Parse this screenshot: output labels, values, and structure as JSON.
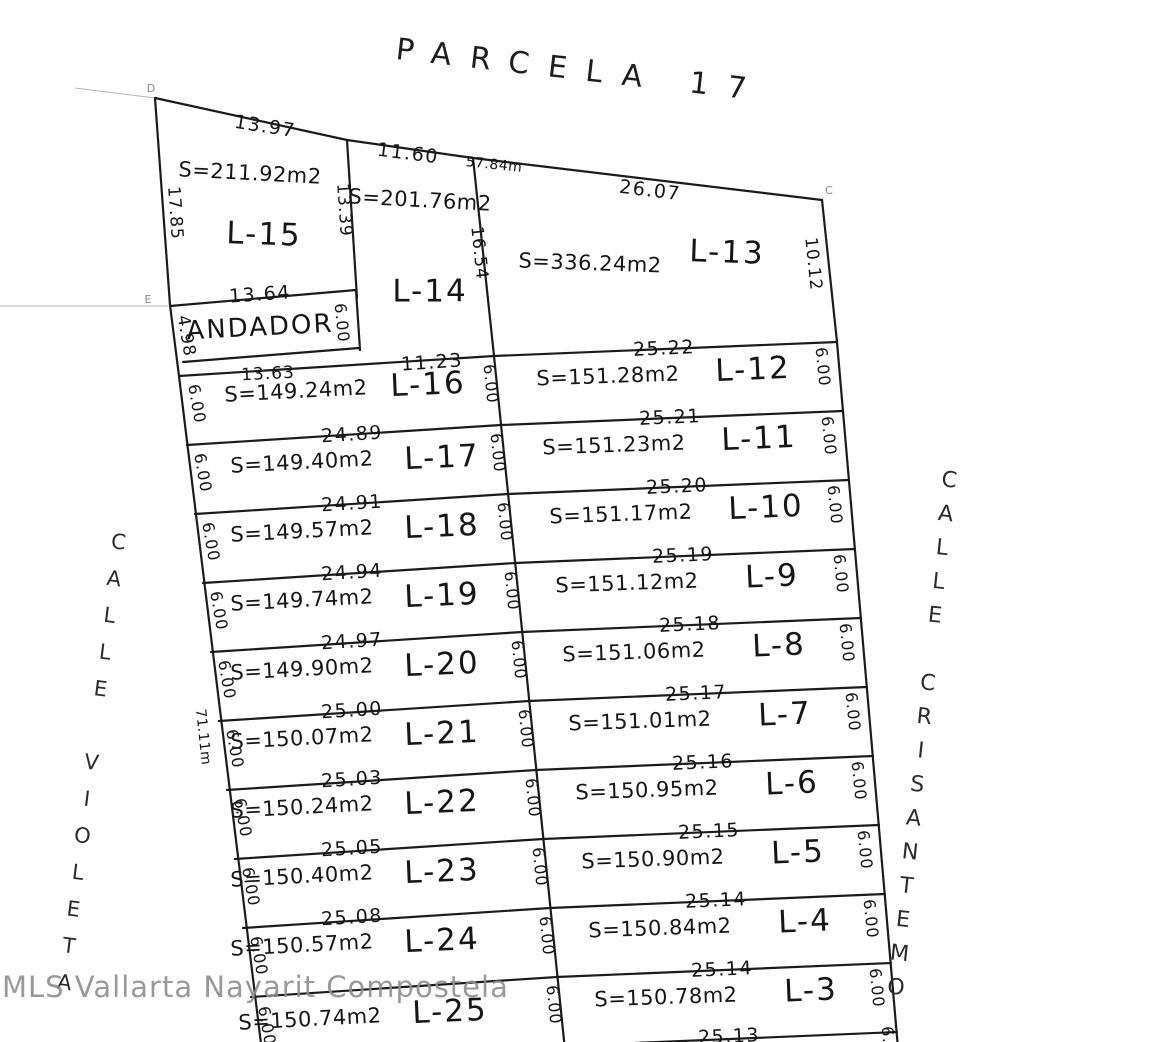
{
  "title": "PARCELA 17",
  "watermark": "MLS Vallarta Nayarit Compostela",
  "streets": {
    "left": "CALLE VIOLETA",
    "right": "CALLE CRISANTEMO"
  },
  "markers": {
    "d": "D",
    "e": "E",
    "c": "C"
  },
  "overall": {
    "top_length": "57.84m",
    "left_length": "71.11m"
  },
  "walkway": {
    "label": "ANDADOR",
    "left": "4.98",
    "right": "6.00"
  },
  "top_lots": [
    {
      "name": "L-15",
      "area": "S=211.92m2",
      "top": "13.97",
      "left": "17.85",
      "right": "13.39",
      "bottom": "13.64"
    },
    {
      "name": "L-14",
      "area": "S=201.76m2",
      "top": "11.60",
      "right": "16.54"
    },
    {
      "name": "L-13",
      "area": "S=336.24m2",
      "top": "26.07",
      "right": "10.12"
    }
  ],
  "left_rows": [
    {
      "name": "L-16",
      "area": "S=149.24m2",
      "top": "13.63",
      "top2": "11.23",
      "left": "6.00",
      "right": "6.00"
    },
    {
      "name": "L-17",
      "area": "S=149.40m2",
      "top": "24.89",
      "left": "6.00",
      "right": "6.00"
    },
    {
      "name": "L-18",
      "area": "S=149.57m2",
      "top": "24.91",
      "left": "6.00",
      "right": "6.00"
    },
    {
      "name": "L-19",
      "area": "S=149.74m2",
      "top": "24.94",
      "left": "6.00",
      "right": "6.00"
    },
    {
      "name": "L-20",
      "area": "S=149.90m2",
      "top": "24.97",
      "left": "6.00",
      "right": "6.00"
    },
    {
      "name": "L-21",
      "area": "S=150.07m2",
      "top": "25.00",
      "left": "6.00",
      "right": "6.00"
    },
    {
      "name": "L-22",
      "area": "S=150.24m2",
      "top": "25.03",
      "left": "6.00",
      "right": "6.00"
    },
    {
      "name": "L-23",
      "area": "S=150.40m2",
      "top": "25.05",
      "left": "6.00",
      "right": "6.00"
    },
    {
      "name": "L-24",
      "area": "S=150.57m2",
      "top": "25.08",
      "left": "6.00",
      "right": "6.00"
    },
    {
      "name": "L-25",
      "area": "S=150.74m2",
      "left": "6.00",
      "right": "6.00"
    }
  ],
  "right_rows": [
    {
      "name": "L-12",
      "area": "S=151.28m2",
      "top": "25.22",
      "right": "6.00"
    },
    {
      "name": "L-11",
      "area": "S=151.23m2",
      "top": "25.21",
      "right": "6.00"
    },
    {
      "name": "L-10",
      "area": "S=151.17m2",
      "top": "25.20",
      "right": "6.00"
    },
    {
      "name": "L-9",
      "area": "S=151.12m2",
      "top": "25.19",
      "right": "6.00"
    },
    {
      "name": "L-8",
      "area": "S=151.06m2",
      "top": "25.18",
      "right": "6.00"
    },
    {
      "name": "L-7",
      "area": "S=151.01m2",
      "top": "25.17",
      "right": "6.00"
    },
    {
      "name": "L-6",
      "area": "S=150.95m2",
      "top": "25.16",
      "right": "6.00"
    },
    {
      "name": "L-5",
      "area": "S=150.90m2",
      "top": "25.15",
      "right": "6.00"
    },
    {
      "name": "L-4",
      "area": "S=150.84m2",
      "top": "25.14",
      "right": "6.00"
    },
    {
      "name": "L-3",
      "area": "S=150.78m2",
      "top": "25.14",
      "right": "6.00"
    }
  ],
  "bottom_row": {
    "top": "25.13",
    "right": "6.00"
  }
}
